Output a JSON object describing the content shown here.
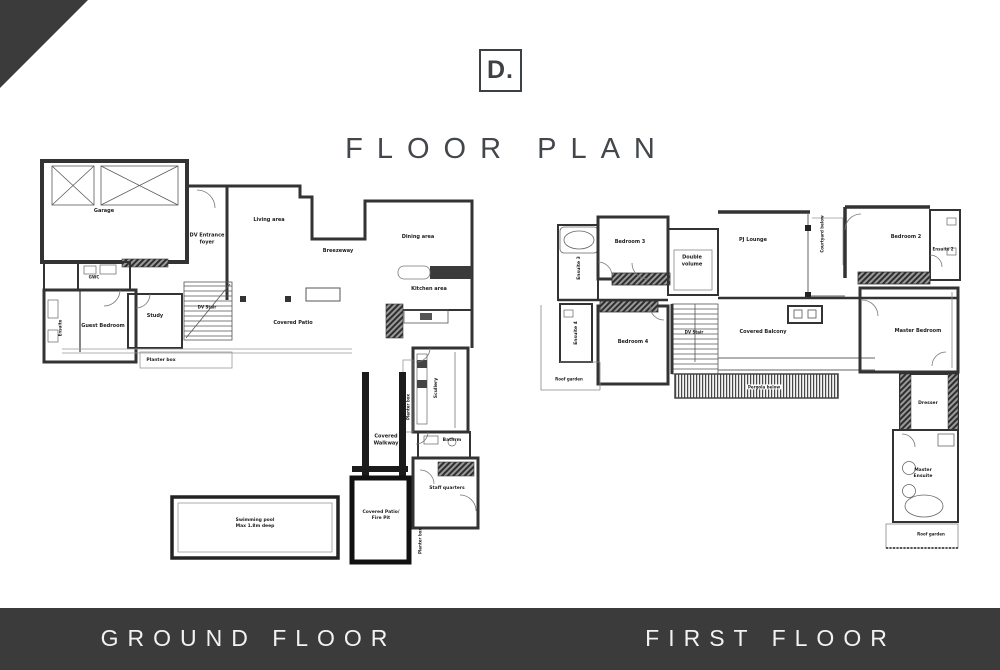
{
  "header": {
    "logo": "D.",
    "title": "FLOOR PLAN"
  },
  "footer": {
    "ground_label": "GROUND FLOOR",
    "first_label": "FIRST FLOOR"
  },
  "colors": {
    "accent_dark": "#3b3b3b",
    "wall": "#333333",
    "footer_text": "#f2f2f2"
  },
  "ground": {
    "garage": "Garage",
    "gwc": "GWC",
    "dv_entrance_foyer": "DV Entrance foyer",
    "living_area": "Living area",
    "breezeway": "Breezeway",
    "dining_area": "Dining area",
    "kitchen_area": "Kitchen area",
    "study": "Study",
    "dv_stair": "DV Stair",
    "guest_bedroom": "Guest Bedroom",
    "ensuite": "Ensuite",
    "covered_patio": "Covered Patio",
    "planter_box": "Planter box",
    "planter_box_2": "Planter box",
    "planter_box_3": "Planter box",
    "scullery": "Scullery",
    "bathrm": "Bathrm",
    "staff_quarters": "Staff quarters",
    "covered_walkway": "Covered Walkway",
    "covered_patio_fire_pit": "Covered Patio/ Fire Pit",
    "pool_line1": "Swimming pool",
    "pool_line2": "Max 1.8m deep"
  },
  "first": {
    "ensuite_3": "Ensuite 3",
    "bedroom_3": "Bedroom 3",
    "double_volume": "Double volume",
    "pj_lounge": "PJ Lounge",
    "courtyard_below": "Courtyard below",
    "bedroom_2": "Bedroom 2",
    "ensuite_2": "Ensuite 2",
    "ensuite_4": "Ensuite 4",
    "bedroom_4": "Bedroom 4",
    "dv_stair": "DV Stair",
    "covered_balcony": "Covered Balcony",
    "pergola_below": "Pergola below",
    "master_bedroom": "Master Bedroom",
    "dresser": "Dresser",
    "master_ensuite": "Master Ensuite",
    "roof_garden_left": "Roof garden",
    "roof_garden_bottom": "Roof garden"
  }
}
